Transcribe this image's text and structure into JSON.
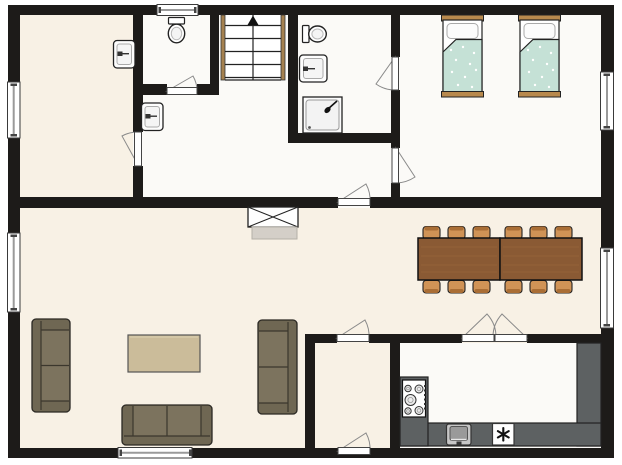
{
  "document": {
    "kind": "architectural floor plan, top-down, no text labels",
    "background": "#ffffff"
  },
  "colors": {
    "wall": "#1d1b19",
    "floor_warm": "#f8f1e5",
    "floor_light": "#fbfaf7",
    "window_glass": "#ffffff",
    "door_arc": "#8a8a8a",
    "stair_wood": "#a5814f",
    "bed_frame_wood": "#b8894d",
    "bed_blanket": "#c5e1d6",
    "dining_table_wood": "#8a5a34",
    "dining_chair_wood": "#d09356",
    "chair_back_wood": "#aa6e35",
    "sofa_fabric": "#6f6753",
    "sofa_seat": "#7c735e",
    "coffee_table_wood": "#cbbc9a",
    "kitchen_counter": "#5d6162",
    "fireplace_hearth": "#d4cfc8",
    "fixture_white": "#fdfdfd"
  },
  "rooms": [
    {
      "id": "room-top-left",
      "label": "room with washbasin",
      "floor": "warm"
    },
    {
      "id": "wc",
      "label": "toilet room with window",
      "floor": "light"
    },
    {
      "id": "staircase-niche",
      "label": "staircase going up",
      "floor": "light"
    },
    {
      "id": "bathroom",
      "label": "bathroom with toilet, washbasin and shower",
      "floor": "light"
    },
    {
      "id": "bedroom",
      "label": "bedroom with two single beds",
      "floor": "light"
    },
    {
      "id": "hallway",
      "label": "hallway with washbasin",
      "floor": "light"
    },
    {
      "id": "living-dining",
      "label": "open living and dining room with fireplace",
      "floor": "warm"
    },
    {
      "id": "entry",
      "label": "entry room with exterior door",
      "floor": "warm"
    },
    {
      "id": "kitchen",
      "label": "kitchen with counters, stove, sink and freezer",
      "floor": "light"
    }
  ],
  "furniture": [
    {
      "name": "single-bed",
      "count": 2
    },
    {
      "name": "dining-table-section",
      "count": 2
    },
    {
      "name": "dining-chair",
      "count": 12
    },
    {
      "name": "sofa",
      "count": 3
    },
    {
      "name": "coffee-table",
      "count": 1
    },
    {
      "name": "fireplace-flue",
      "count": 1
    },
    {
      "name": "toilet",
      "count": 2
    },
    {
      "name": "washbasin",
      "count": 3
    },
    {
      "name": "shower",
      "count": 1
    },
    {
      "name": "kitchen-sink",
      "count": 1
    },
    {
      "name": "freezer-appliance",
      "count": 1
    },
    {
      "name": "stove-burner",
      "count": 5
    }
  ],
  "openings": {
    "windows": 6,
    "door_swings": 9,
    "french_door_leaves": 2,
    "stair_steps": 5
  },
  "icons": {
    "stair_direction_arrow": "up",
    "freezer_symbol": "six-spoke asterisk"
  }
}
